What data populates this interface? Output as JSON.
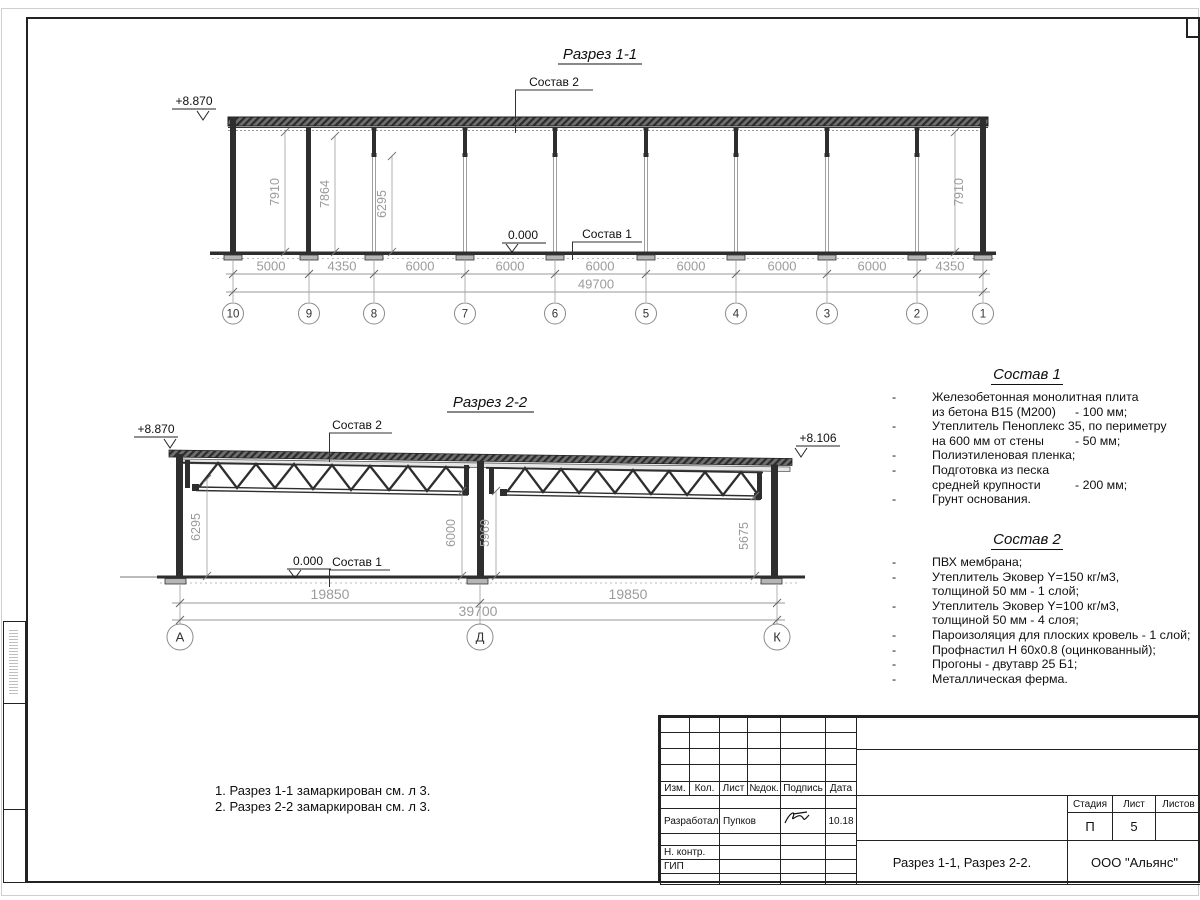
{
  "section1": {
    "title": "Разрез 1-1",
    "level_top": "+8.870",
    "level_zero": "0.000",
    "callout_top": "Состав 2",
    "callout_floor": "Состав 1",
    "span_dims": [
      "5000",
      "4350",
      "6000",
      "6000",
      "6000",
      "6000",
      "6000",
      "6000",
      "4350"
    ],
    "total_dim": "49700",
    "height_dims": [
      "7910",
      "7864",
      "6295",
      "7910"
    ],
    "axes": [
      "10",
      "9",
      "8",
      "7",
      "6",
      "5",
      "4",
      "3",
      "2",
      "1"
    ]
  },
  "section2": {
    "title": "Разрез 2-2",
    "level_top_left": "+8.870",
    "level_top_right": "+8.106",
    "level_zero": "0.000",
    "callout_top": "Состав 2",
    "callout_floor": "Состав 1",
    "span_dims": [
      "19850",
      "19850"
    ],
    "total_dim": "39700",
    "height_dims": [
      "6295",
      "6000",
      "5969",
      "5675"
    ],
    "axes": [
      "А",
      "Д",
      "К"
    ]
  },
  "sostav1": {
    "title": "Состав 1",
    "rows": [
      {
        "d": "-",
        "t": "Железобетонная  монолитная плита",
        "v": ""
      },
      {
        "d": "",
        "t": "из бетона В15 (М200)",
        "v": "- 100 мм;"
      },
      {
        "d": "-",
        "t": "Утеплитель Пеноплекс 35, по периметру",
        "v": ""
      },
      {
        "d": "",
        "t": "на 600 мм от стены",
        "v": "- 50 мм;"
      },
      {
        "d": "-",
        "t": "Полиэтиленовая пленка;",
        "v": ""
      },
      {
        "d": "-",
        "t": "Подготовка из песка",
        "v": ""
      },
      {
        "d": "",
        "t": "средней крупности",
        "v": "- 200 мм;"
      },
      {
        "d": "-",
        "t": "Грунт основания.",
        "v": ""
      }
    ]
  },
  "sostav2": {
    "title": "Состав 2",
    "rows": [
      {
        "d": "-",
        "t": "ПВХ мембрана;"
      },
      {
        "d": "-",
        "t": "Утеплитель Эковер Y=150 кг/м3,"
      },
      {
        "d": "",
        "t": "толщиной 50 мм - 1 слой;"
      },
      {
        "d": "-",
        "t": "Утеплитель Эковер Y=100 кг/м3,"
      },
      {
        "d": "",
        "t": "толщиной 50 мм - 4 слоя;"
      },
      {
        "d": "-",
        "t": "Пароизоляция для плоских кровель - 1 слой;"
      },
      {
        "d": "-",
        "t": "Профнастил Н 60х0.8 (оцинкованный);"
      },
      {
        "d": "-",
        "t": "Прогоны - двутавр 25 Б1;"
      },
      {
        "d": "-",
        "t": "Металлическая ферма."
      }
    ]
  },
  "notes": {
    "line1": "1. Разрез 1-1 замаркирован см. л 3.",
    "line2": "2. Разрез 2-2 замаркирован см. л 3."
  },
  "titleblock": {
    "rev_headers": [
      "Изм.",
      "Кол.",
      "Лист",
      "№док.",
      "Подпись",
      "Дата"
    ],
    "developed_label": "Разработал",
    "developed_name": "Пупков",
    "developed_date": "10.18",
    "ncontrol_label": "Н. контр.",
    "gip_label": "ГИП",
    "stage_header": "Стадия",
    "sheet_header": "Лист",
    "sheets_header": "Листов",
    "stage_value": "П",
    "sheet_value": "5",
    "sheets_value": "",
    "doc_title": "Разрез 1-1, Разрез 2-2.",
    "company": "ООО \"Альянс\""
  }
}
